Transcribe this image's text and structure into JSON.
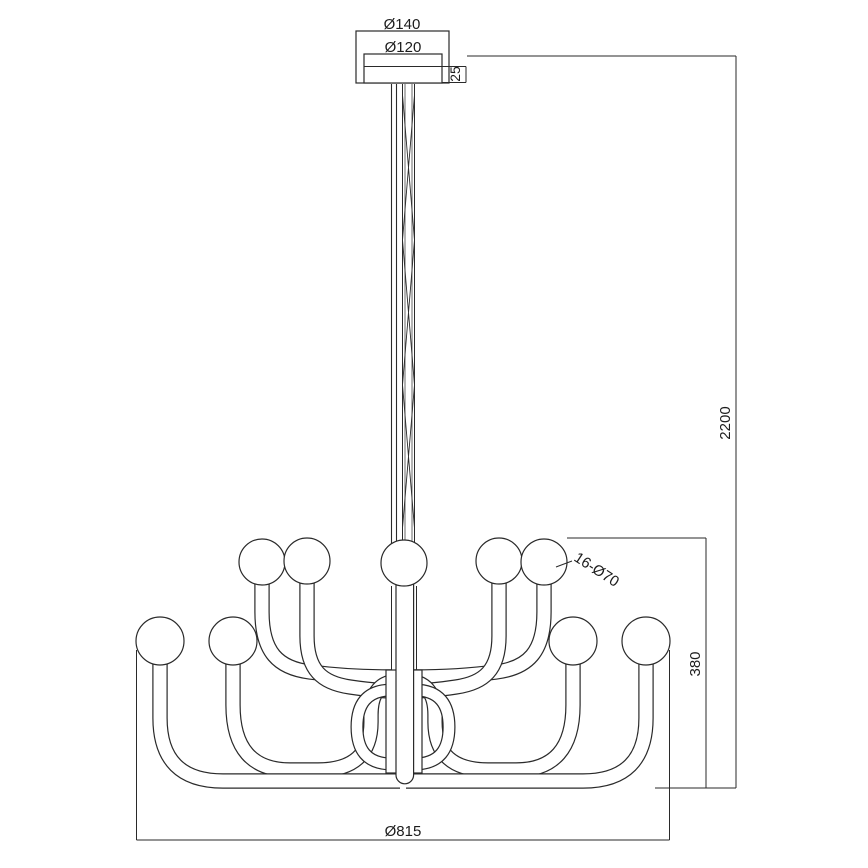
{
  "diagram": {
    "title": "chandelier-dimension-drawing",
    "labels": {
      "canopy_outer_diameter": "Ø140",
      "canopy_inner_diameter": "Ø120",
      "canopy_height": "25",
      "total_drop": "2200",
      "fixture_height": "380",
      "bulb_spec": "16-Ø70",
      "fixture_diameter": "Ø815"
    },
    "style": {
      "line_color": "#2a2a2a",
      "background": "#ffffff"
    }
  }
}
